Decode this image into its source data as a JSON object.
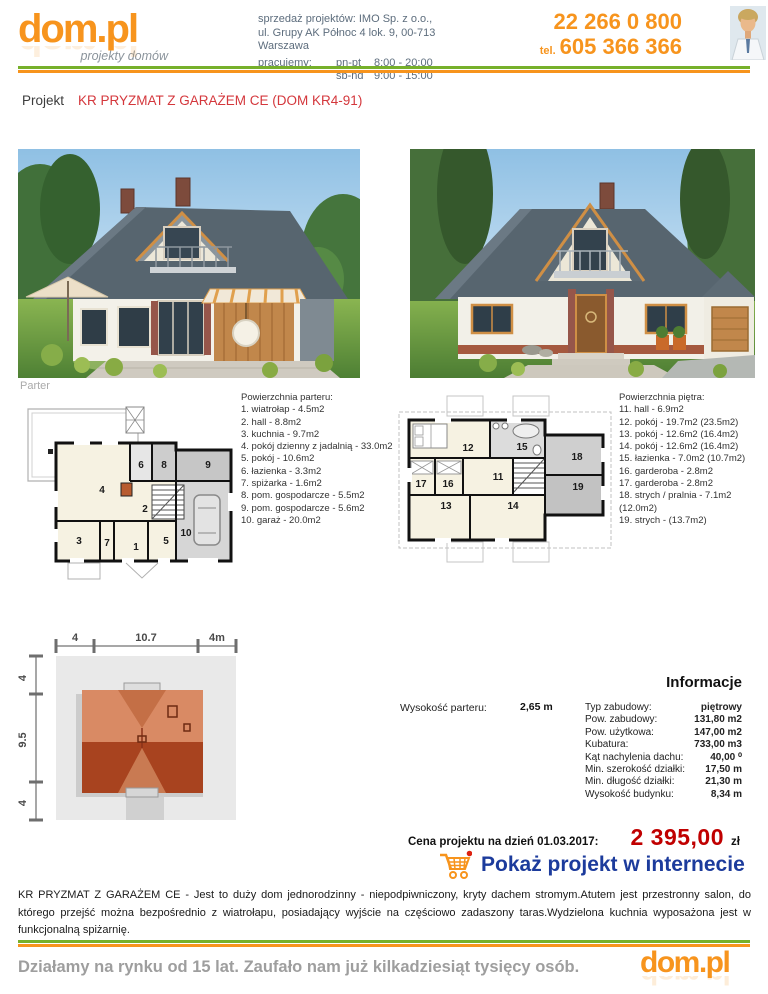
{
  "colors": {
    "accent_orange": "#f7941d",
    "title_red": "#d4373c",
    "price_red": "#c00000",
    "link_blue": "#1c3b9c",
    "divider_green": "#76b02a"
  },
  "header": {
    "logo": {
      "text": "dom.pl",
      "tagline": "projekty domów"
    },
    "company_line1": "sprzedaż projektów: IMO Sp. z o.o.,",
    "company_line2": "ul. Grupy AK Północ 4 lok. 9, 00-713 Warszawa",
    "hours_label": "pracujemy:",
    "hours": [
      {
        "days": "pn-pt",
        "time": "8:00 - 20:00"
      },
      {
        "days": "sb-nd",
        "time": "9:00 - 15:00"
      }
    ],
    "phone_main": "22 266 0 800",
    "phone_tel_label": "tel.",
    "phone_mobile": "605 366 366"
  },
  "project": {
    "label": "Projekt",
    "name": "KR PRYZMAT Z GARAŻEM CE (DOM KR4-91)"
  },
  "floorplans": {
    "parter_caption": "Parter",
    "parter": {
      "heading": "Powierzchnia parteru:",
      "rooms": [
        "1. wiatrołap - 4.5m2",
        "2. hall - 8.8m2",
        "3. kuchnia - 9.7m2",
        "4. pokój dzienny z jadalnią - 33.0m2",
        "5. pokój - 10.6m2",
        "6. łazienka - 3.3m2",
        "7. spiżarka - 1.6m2",
        "8. pom. gospodarcze - 5.5m2",
        "9. pom. gospodarcze - 5.6m2",
        "10. garaż - 20.0m2"
      ],
      "labels": [
        "1",
        "2",
        "3",
        "4",
        "5",
        "6",
        "7",
        "8",
        "9",
        "10"
      ]
    },
    "pietro": {
      "heading": "Powierzchnia piętra:",
      "rooms": [
        "11. hall - 6.9m2",
        "12. pokój - 19.7m2  (23.5m2)",
        "13. pokój - 12.6m2  (16.4m2)",
        "14. pokój - 12.6m2  (16.4m2)",
        "15. łazienka - 7.0m2  (10.7m2)",
        "16. garderoba - 2.8m2",
        "17. garderoba - 2.8m2",
        "18. strych / pralnia - 7.1m2  (12.0m2)",
        "19. strych - (13.7m2)"
      ],
      "labels": [
        "11",
        "12",
        "13",
        "14",
        "15",
        "16",
        "17",
        "18",
        "19"
      ]
    }
  },
  "siteplan": {
    "top_dims": [
      "4",
      "10.7",
      "4m"
    ],
    "left_dims": [
      "4",
      "9.5",
      "4"
    ]
  },
  "info": {
    "heading": "Informacje",
    "ground_height_label": "Wysokość parteru:",
    "ground_height_value": "2,65 m",
    "rows": [
      {
        "label": "Typ zabudowy:",
        "value": "piętrowy"
      },
      {
        "label": "Pow. zabudowy:",
        "value": "131,80 m2"
      },
      {
        "label": "Pow. użytkowa:",
        "value": "147,00 m2"
      },
      {
        "label": "Kubatura:",
        "value": "733,00 m3"
      },
      {
        "label": "Kąt nachylenia dachu:",
        "value": "40,00 ⁰"
      },
      {
        "label": "Min. szerokość działki:",
        "value": "17,50 m"
      },
      {
        "label": "Min. długość działki:",
        "value": "21,30 m"
      },
      {
        "label": "Wysokość budynku:",
        "value": "8,34 m"
      }
    ]
  },
  "price": {
    "label": "Cena projektu na dzień 01.03.2017:",
    "amount": "2 395,00",
    "currency": "zł"
  },
  "cta": {
    "label": "Pokaż projekt w internecie"
  },
  "description": "KR PRYZMAT Z GARAŻEM CE - Jest to duży dom jednorodzinny - niepodpiwniczony, kryty dachem stromym.Atutem jest przestronny salon, do którego przejść można bezpośrednio z wiatrołapu, posiadający wyjście na częściowo zadaszony taras.Wydzielona kuchnia wyposażona jest w funkcjonalną spiżarnię.",
  "footer": {
    "text": "Działamy na rynku od 15 lat. Zaufało nam już kilkadziesiąt tysięcy osób.",
    "logo": "dom.pl"
  }
}
